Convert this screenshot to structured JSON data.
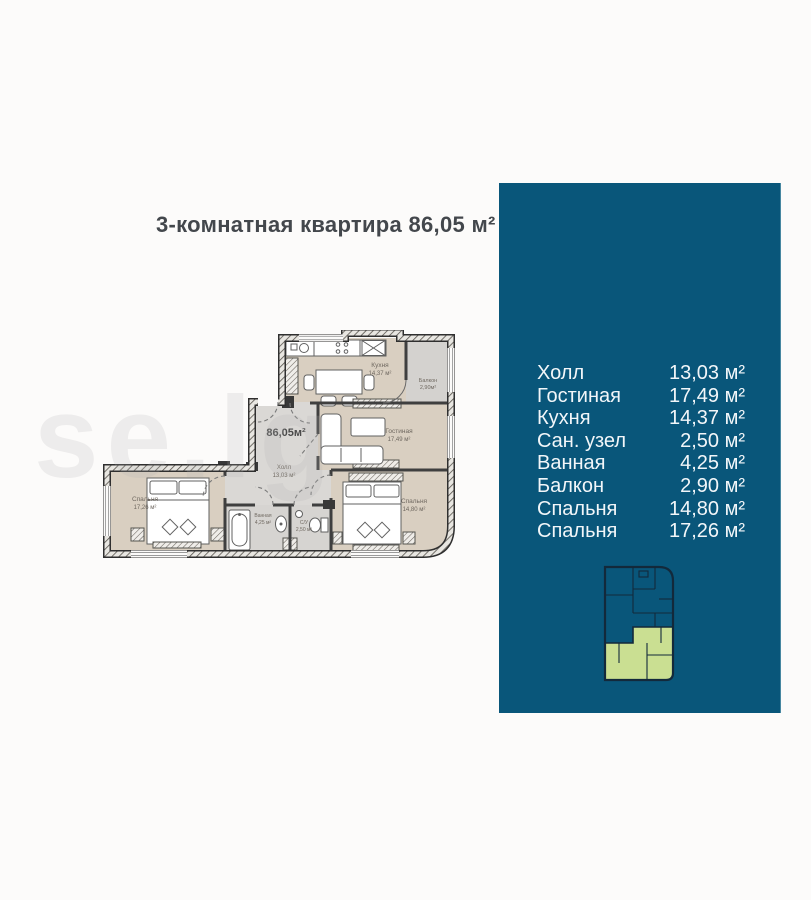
{
  "title": "3-комнатная квартира 86,05 м²",
  "watermark": "se.lg",
  "colors": {
    "panel_background": "#09567a",
    "panel_text": "#f2f6f9",
    "locator_highlight": "#cadf92",
    "locator_lines": "#13293b",
    "room_fill": "#d9cfc1",
    "wet_room_fill": "#d6d4d1",
    "wall": "#2f2f2f"
  },
  "floor_plan": {
    "total_area": "86,05м²",
    "labels": {
      "kitchen": {
        "name": "Кухня",
        "area": "14,37 м²"
      },
      "balcony": {
        "name": "Балкон",
        "area": "2,90м²"
      },
      "living": {
        "name": "Гостиная",
        "area": "17,49 м²"
      },
      "hall": {
        "name": "Холл",
        "area": "13,03 м²"
      },
      "bedroom_left": {
        "name": "Спальня",
        "area": "17,26 м²"
      },
      "bath": {
        "name": "Ванная",
        "area": "4,25 м²"
      },
      "wc": {
        "name": "С/У",
        "area": "2,50 м²"
      },
      "bedroom_right": {
        "name": "Спальня",
        "area": "14,80 м²"
      }
    }
  },
  "panel": {
    "rooms": [
      {
        "label": "Холл",
        "area": "13,03 м²"
      },
      {
        "label": "Гостиная",
        "area": "17,49 м²"
      },
      {
        "label": "Кухня",
        "area": "14,37 м²"
      },
      {
        "label": "Сан. узел",
        "area": "2,50 м²"
      },
      {
        "label": "Ванная",
        "area": "4,25 м²"
      },
      {
        "label": "Балкон",
        "area": "2,90 м²"
      },
      {
        "label": "Спальня",
        "area": "14,80 м²"
      },
      {
        "label": "Спальня",
        "area": "17,26 м²"
      }
    ]
  }
}
